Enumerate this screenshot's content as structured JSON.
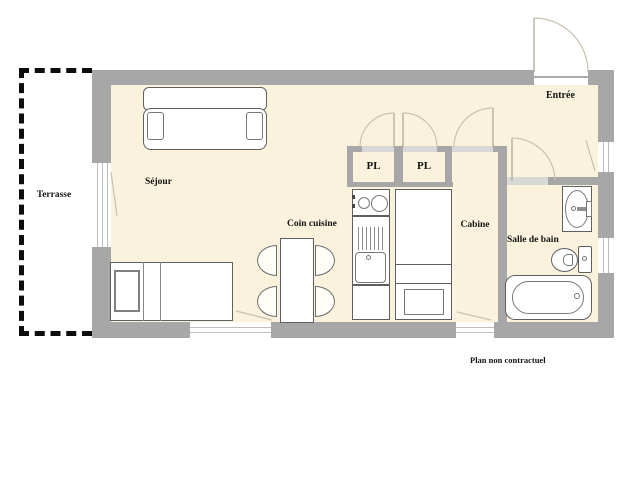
{
  "rooms": [
    {
      "id": "terrasse",
      "label": "Terrasse"
    },
    {
      "id": "sejour",
      "label": "Séjour"
    },
    {
      "id": "coin-cuisine",
      "label": "Coin cuisine"
    },
    {
      "id": "pl-1",
      "label": "PL"
    },
    {
      "id": "pl-2",
      "label": "PL"
    },
    {
      "id": "cabine",
      "label": "Cabine"
    },
    {
      "id": "salle-de-bain",
      "label": "Salle de bain"
    },
    {
      "id": "entree",
      "label": "Entrée"
    }
  ],
  "note": "Plan non contractuel",
  "fixtures": [
    "sofa",
    "single-bed",
    "dining-table",
    "four-chairs",
    "cooktop",
    "kitchen-sink",
    "tall-unit",
    "washbasin",
    "toilet",
    "bathtub",
    "entrance-door",
    "closet-doors",
    "windows"
  ],
  "colors": {
    "wall": "#a7a7a7",
    "floor": "#faf2dd",
    "opening": "#d8d8d5",
    "outline": "#5f5f5f",
    "swing": "#c9c1ac",
    "text": "#141414"
  }
}
